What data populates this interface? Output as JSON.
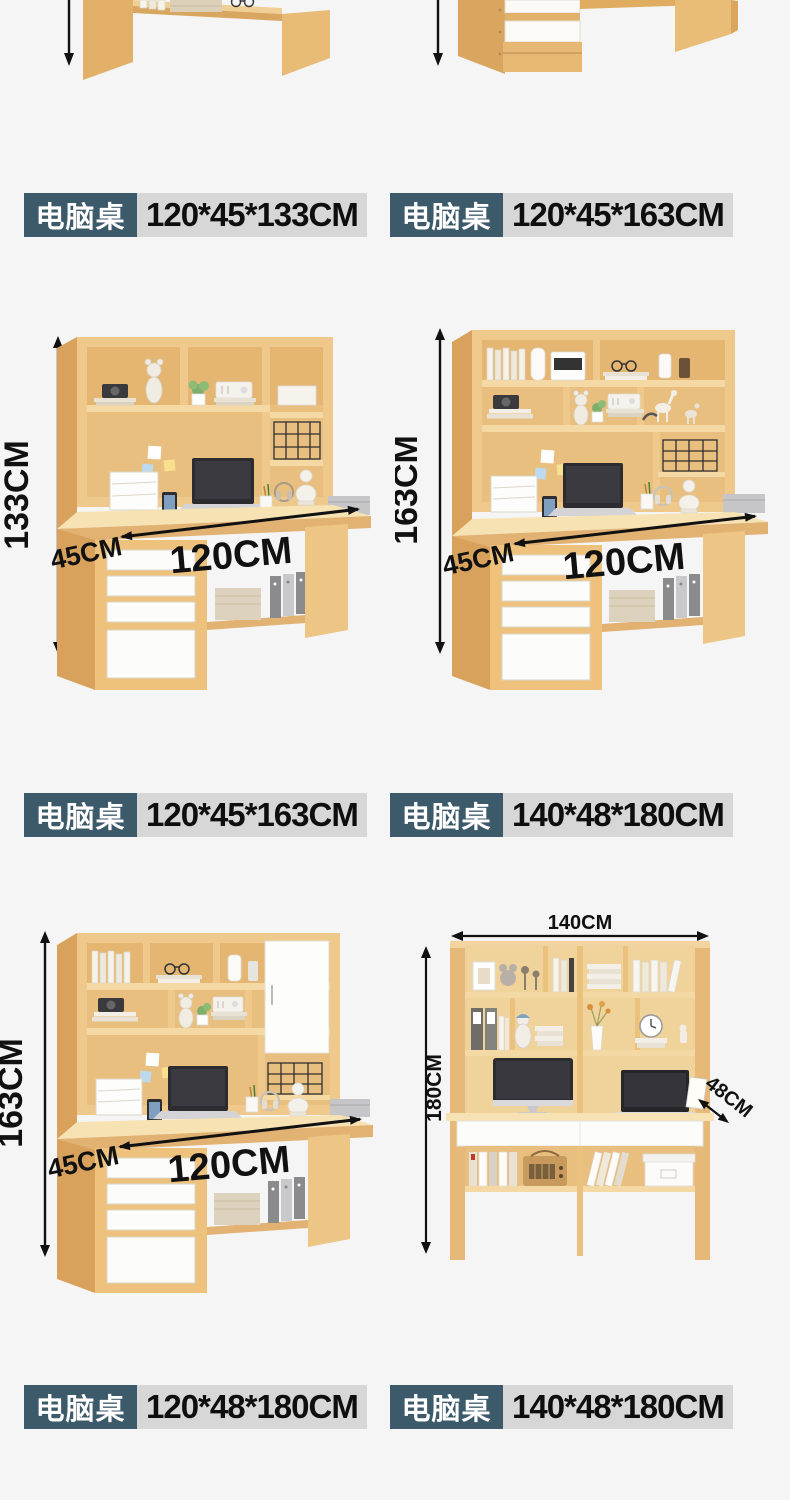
{
  "page": {
    "background": "#f5f5f5"
  },
  "colors": {
    "label_name_bg": "#3d5a6a",
    "label_name_text": "#ffffff",
    "label_size_bg": "#d7d7d7",
    "label_size_text": "#0e0e0e",
    "dimension_text": "#111111",
    "arrow": "#111111",
    "wood_front": "#efc98c",
    "wood_side": "#d8a25c",
    "wood_inner": "#e9bf7f",
    "wood_top": "#f7e2b4",
    "drawer_white": "#fcfcfa"
  },
  "spec_labels": [
    {
      "product": "电脑桌",
      "size": "120*45*133CM"
    },
    {
      "product": "电脑桌",
      "size": "120*45*163CM"
    },
    {
      "product": "电脑桌",
      "size": "120*45*163CM"
    },
    {
      "product": "电脑桌",
      "size": "140*48*180CM"
    },
    {
      "product": "电脑桌",
      "size": "120*48*180CM"
    },
    {
      "product": "电脑桌",
      "size": "140*48*180CM"
    }
  ],
  "figures": [
    {
      "variant": "hutch-desk-perspective",
      "width": "120CM",
      "depth": "45CM",
      "height": "133CM"
    },
    {
      "variant": "hutch-desk-perspective",
      "width": "120CM",
      "depth": "45CM",
      "height": "163CM"
    },
    {
      "variant": "hutch-desk-perspective-with-cabinet",
      "width": "120CM",
      "depth": "45CM",
      "height": "163CM"
    },
    {
      "variant": "double-desk-front-view",
      "width": "140CM",
      "depth": "48CM",
      "height": "180CM"
    }
  ]
}
